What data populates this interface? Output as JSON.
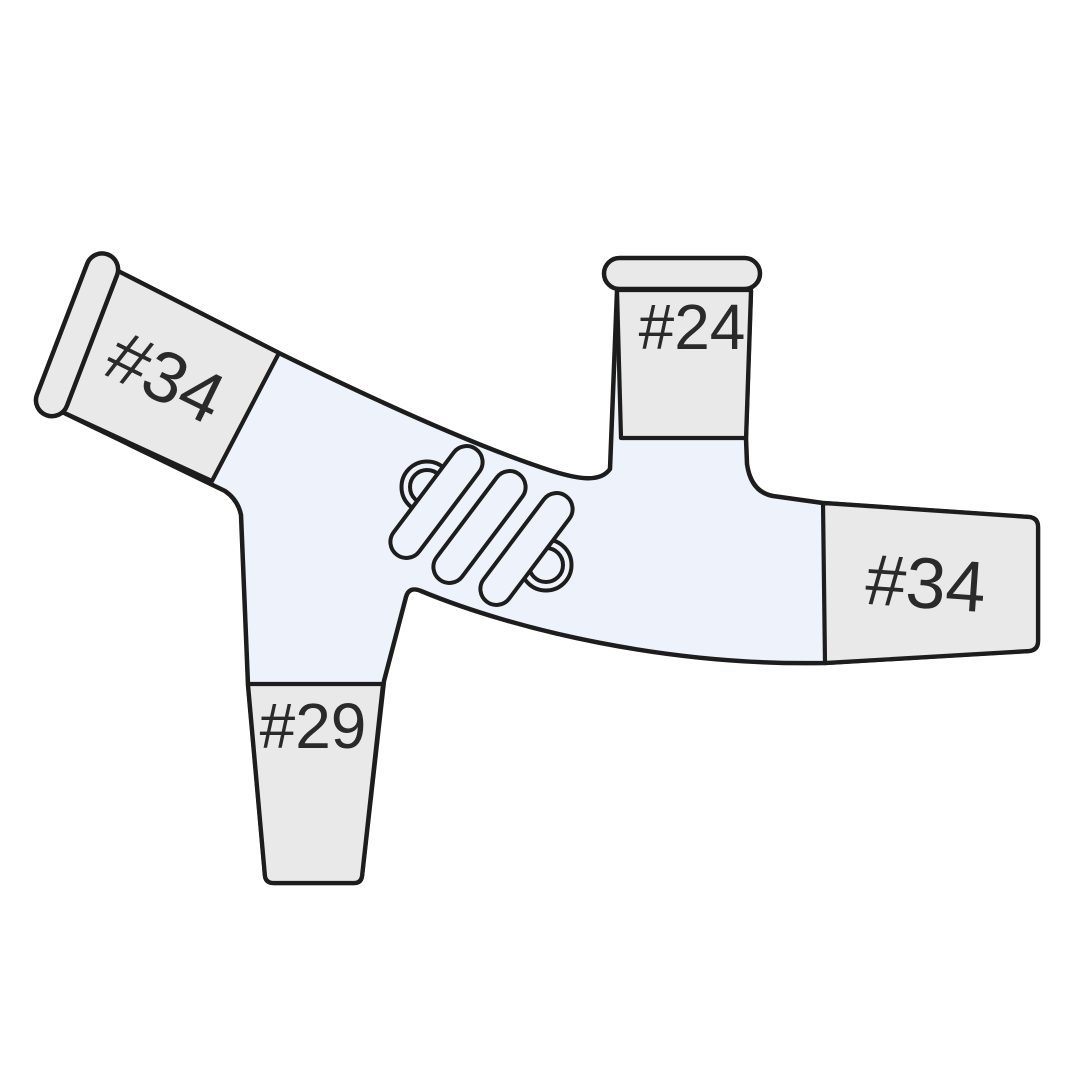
{
  "diagram": {
    "subject": "lab-glassware-distillation-adapter",
    "joints": [
      {
        "position": "upper-left",
        "label": "#34"
      },
      {
        "position": "top",
        "label": "#24"
      },
      {
        "position": "right",
        "label": "#34"
      },
      {
        "position": "bottom",
        "label": "#29"
      }
    ],
    "features": [
      {
        "name": "condenser-coil"
      }
    ]
  },
  "colors": {
    "background": "#ffffff",
    "glass_fill": "#edf2fb",
    "frost_fill": "#e9e9ea",
    "outline": "#1d1d1d",
    "label_text": "#2a2a2a"
  }
}
